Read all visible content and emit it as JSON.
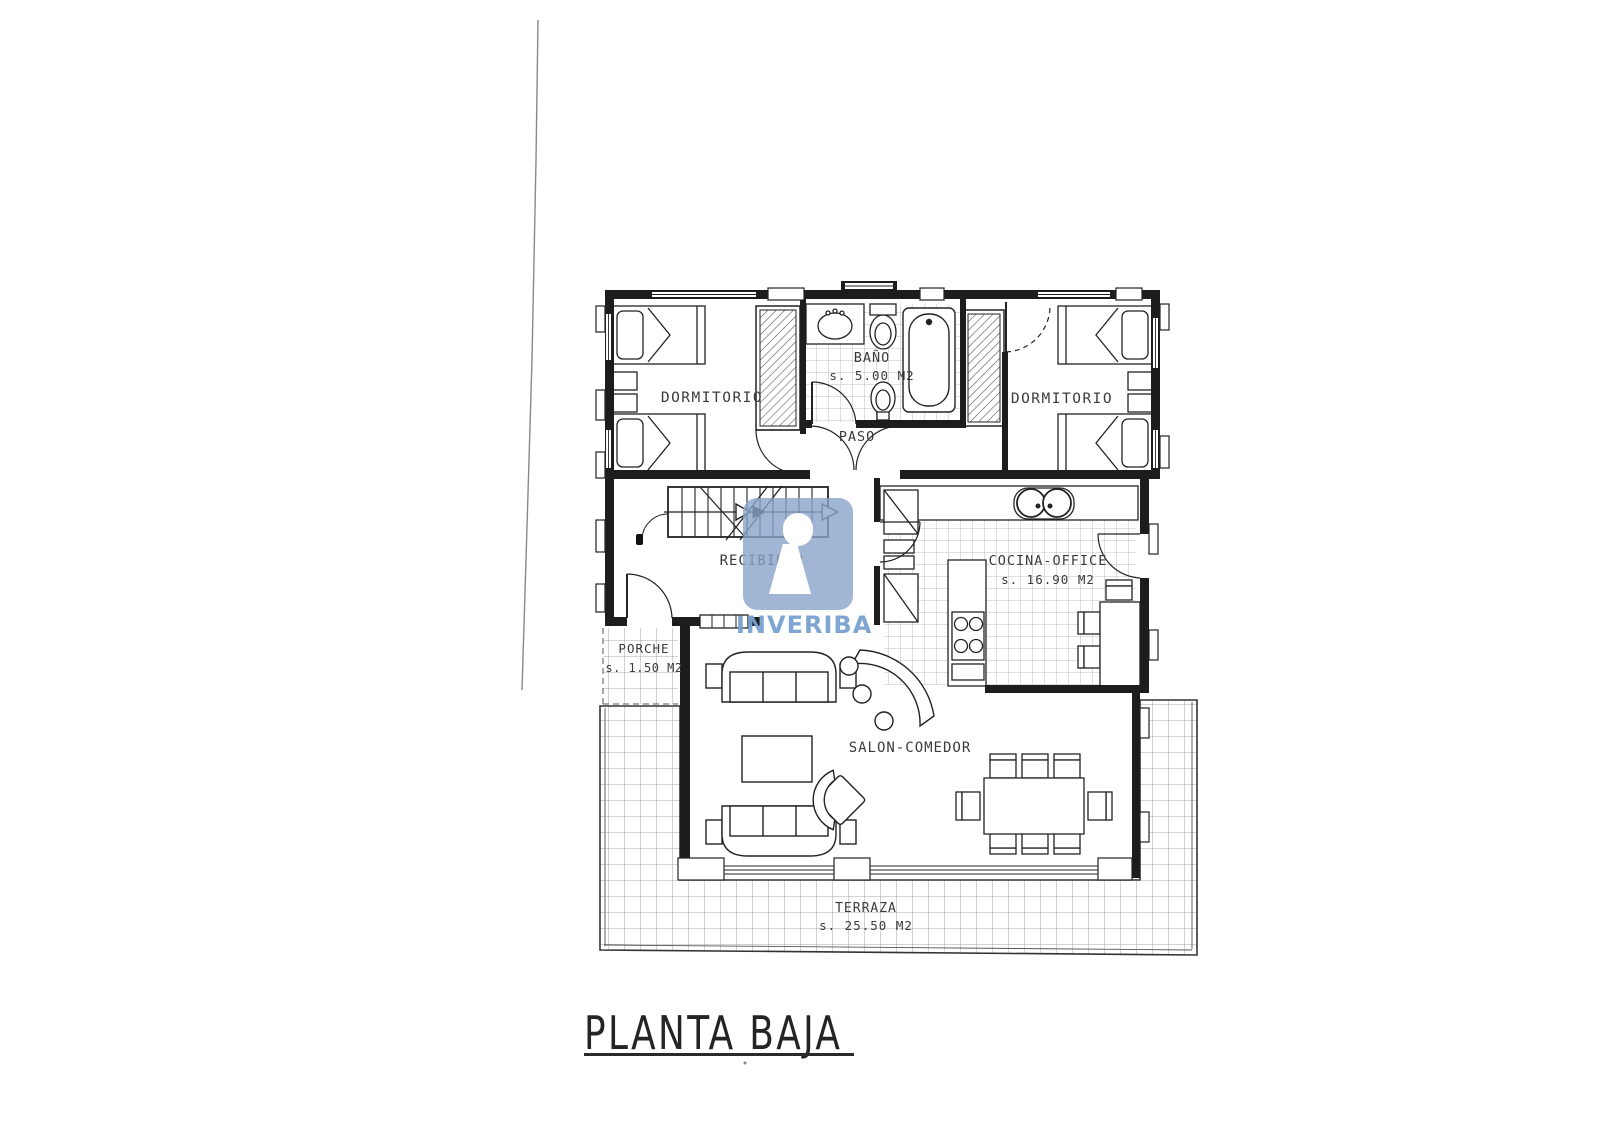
{
  "document": {
    "title": "PLANTA BAJA"
  },
  "watermark": {
    "brand": "INVERIBA",
    "square_color": "#89a4c9",
    "text_color": "#78a1d0"
  },
  "rooms": {
    "dormitorio_izq": {
      "name": "DORMITORIO"
    },
    "dormitorio_der": {
      "name": "DORMITORIO"
    },
    "bano": {
      "name": "BAÑO",
      "area": "s. 5.00 M2"
    },
    "paso": {
      "name": "PASO"
    },
    "recibidor": {
      "name": "RECIBIDOR"
    },
    "cocina_office": {
      "name": "COCINA-OFFICE",
      "area": "s. 16.90 M2"
    },
    "porche": {
      "name": "PORCHE",
      "area": "s. 1.50 M2"
    },
    "salon_comedor": {
      "name": "SALON-COMEDOR"
    },
    "terraza": {
      "name": "TERRAZA",
      "area": "s. 25.50 M2"
    }
  },
  "colors": {
    "ink": "#1d1d1d"
  }
}
